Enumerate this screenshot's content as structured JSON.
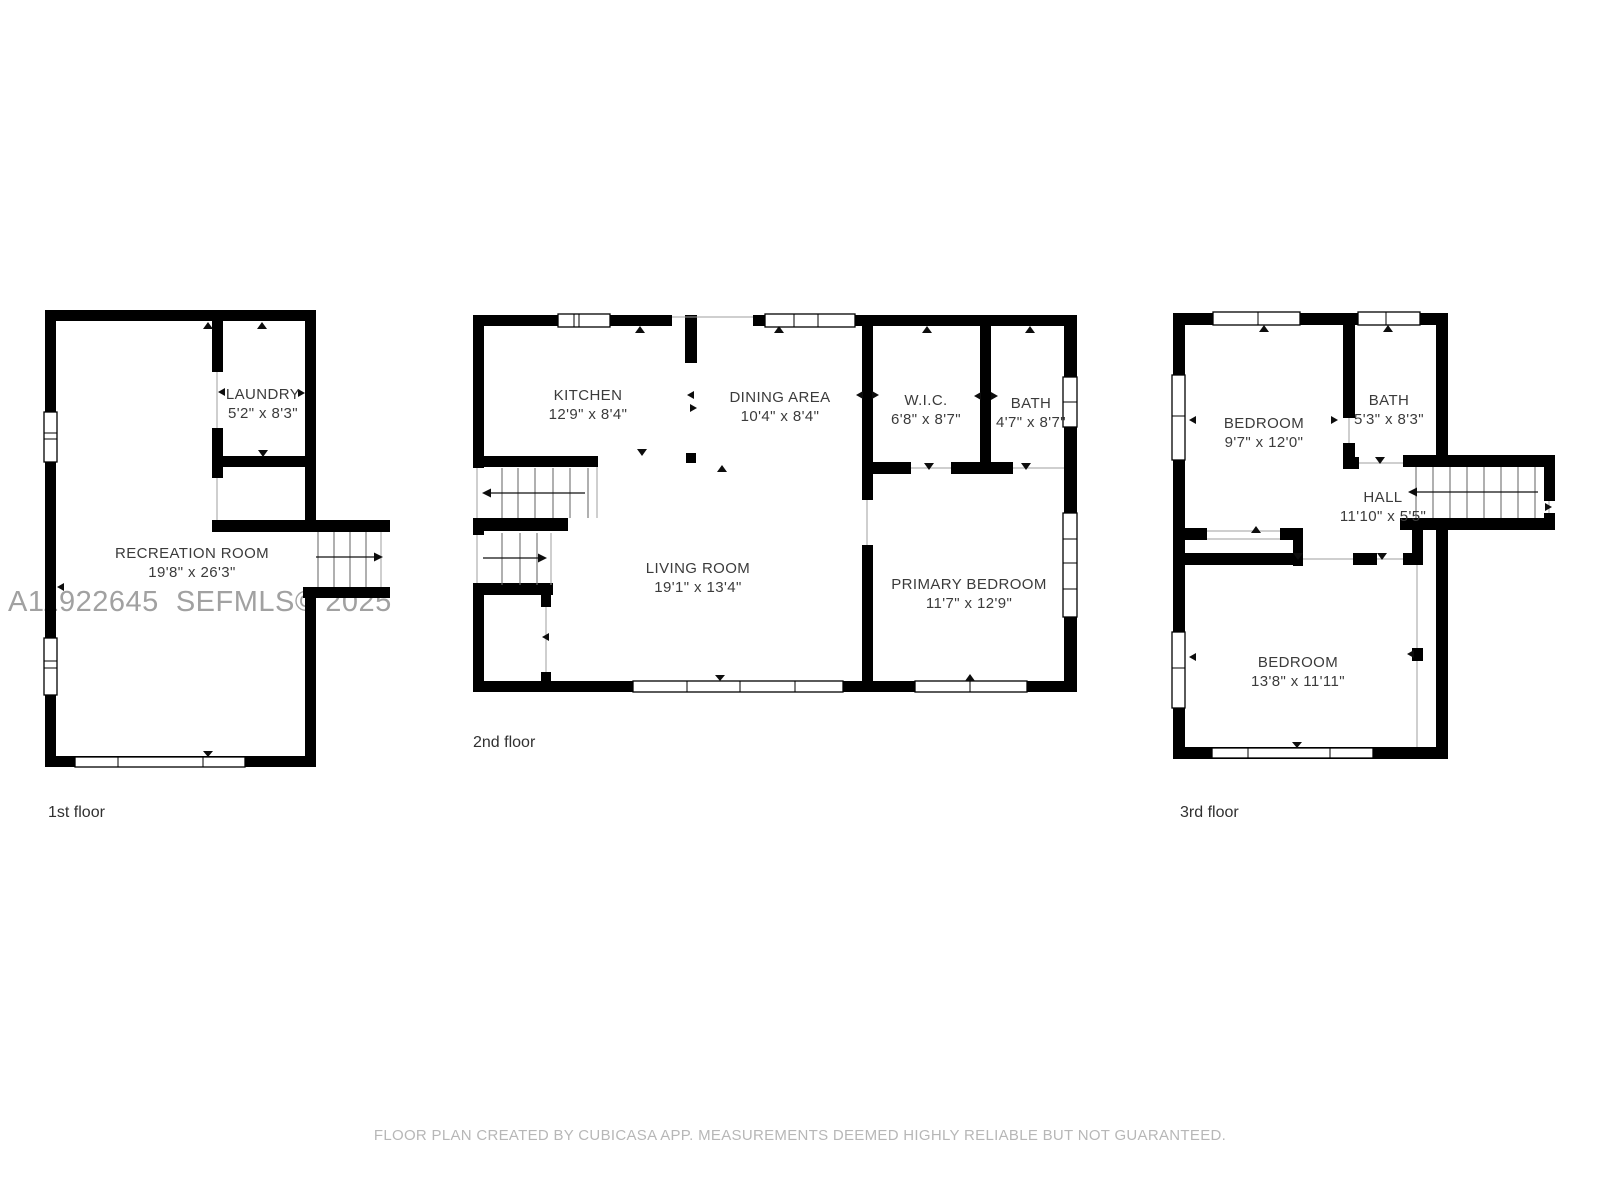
{
  "page": {
    "watermark": "A11922645  SEFMLS© 2025",
    "footer": "FLOOR PLAN CREATED BY CUBICASA APP. MEASUREMENTS DEEMED HIGHLY RELIABLE BUT NOT GUARANTEED."
  },
  "colors": {
    "wall": "#000000",
    "room_label": "#3b3b3b",
    "floor_label": "#303030",
    "watermark": "#a1a1a1",
    "footer": "#b7b7b7"
  },
  "floors": [
    {
      "label": "1st floor",
      "rooms": [
        {
          "name": "LAUNDRY",
          "dims": "5'2\" x 8'3\""
        },
        {
          "name": "RECREATION ROOM",
          "dims": "19'8\" x 26'3\""
        }
      ]
    },
    {
      "label": "2nd floor",
      "rooms": [
        {
          "name": "KITCHEN",
          "dims": "12'9\" x 8'4\""
        },
        {
          "name": "DINING AREA",
          "dims": "10'4\" x 8'4\""
        },
        {
          "name": "W.I.C.",
          "dims": "6'8\" x 8'7\""
        },
        {
          "name": "BATH",
          "dims": "4'7\" x 8'7\""
        },
        {
          "name": "LIVING ROOM",
          "dims": "19'1\" x 13'4\""
        },
        {
          "name": "PRIMARY BEDROOM",
          "dims": "11'7\" x 12'9\""
        }
      ]
    },
    {
      "label": "3rd floor",
      "rooms": [
        {
          "name": "BEDROOM",
          "dims": "9'7\" x 12'0\""
        },
        {
          "name": "BATH",
          "dims": "5'3\" x 8'3\""
        },
        {
          "name": "HALL",
          "dims": "11'10\" x 5'5\""
        },
        {
          "name": "BEDROOM",
          "dims": "13'8\" x 11'11\""
        }
      ]
    }
  ]
}
